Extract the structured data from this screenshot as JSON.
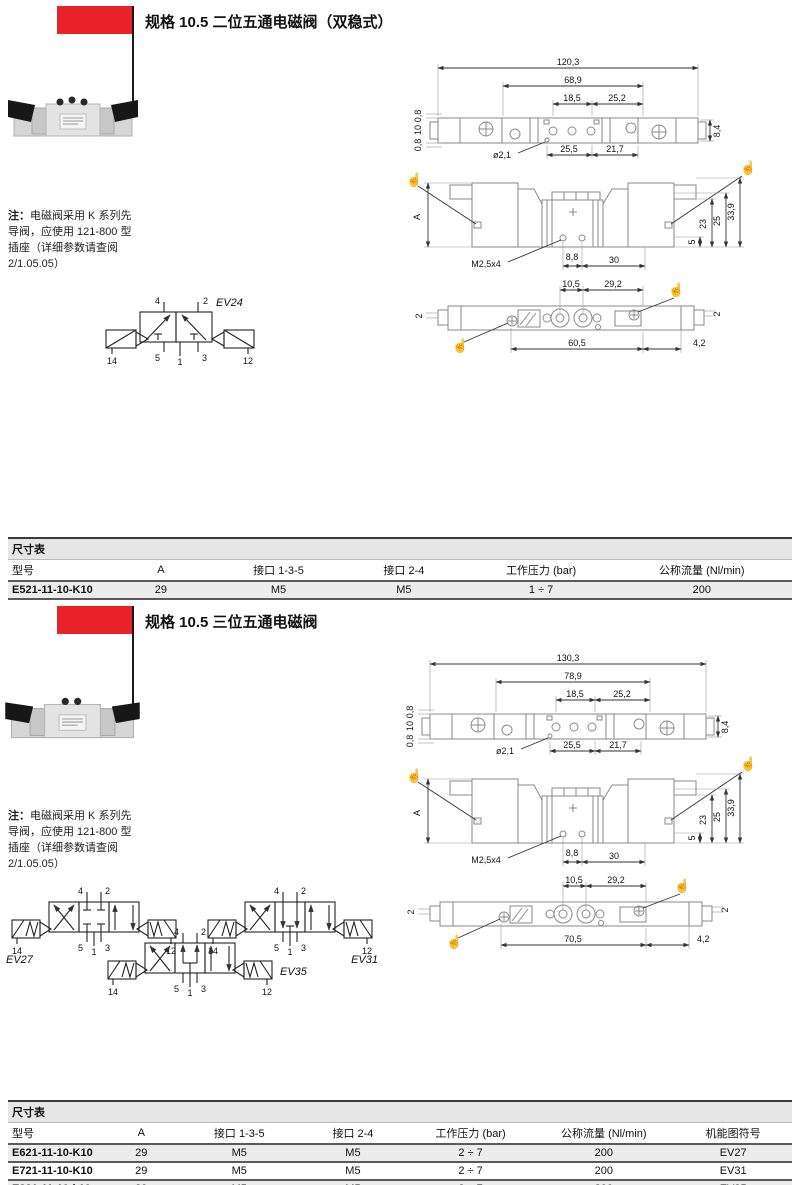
{
  "colors": {
    "accent": "#e8212b",
    "table_caption_bg": "#e6e6e6",
    "row_alt_bg": "#ececec"
  },
  "note": {
    "prefix": "注：",
    "l1": "电磁阀采用 K 系列先",
    "l2": "导阀，应使用 121-800 型",
    "l3": "插座（详细参数请查阅",
    "l4": "2/1.05.05）"
  },
  "ports": {
    "p14": "14",
    "p4": "4",
    "p2": "2",
    "p5": "5",
    "p1": "1",
    "p3": "3",
    "p12": "12"
  },
  "s1": {
    "title": "规格 10.5 二位五通电磁阀（双稳式）",
    "symbol": "EV24",
    "top": {
      "d1": "120,3",
      "d2": "68,9",
      "d3": "18,5",
      "d4": "25,2",
      "l1": "0,8",
      "l2": "10",
      "l3": "0,8",
      "r1": "8,4",
      "b1": "ø2,1",
      "b2": "25,5",
      "b3": "21,7"
    },
    "front": {
      "a": "A",
      "thread": "M2,5x4",
      "b1": "8,8",
      "b2": "30",
      "r1": "5",
      "r2": "23",
      "r3": "25",
      "r4": "33,9"
    },
    "bottom": {
      "t1": "10,5",
      "t2": "29,2",
      "s1": "2",
      "s2": "2",
      "b1": "60,5",
      "b2": "4,2"
    },
    "table": {
      "caption": "尺寸表",
      "h": [
        "型号",
        "A",
        "接口 1-3-5",
        "接口 2-4",
        "工作压力 (bar)",
        "公称流量 (Nl/min)"
      ],
      "rows": [
        [
          "E521-11-10-K10",
          "29",
          "M5",
          "M5",
          "1 ÷ 7",
          "200"
        ]
      ]
    }
  },
  "s2": {
    "title": "规格 10.5 三位五通电磁阀",
    "symbol27": "EV27",
    "symbol31": "EV31",
    "symbol35": "EV35",
    "top": {
      "d1": "130,3",
      "d2": "78,9",
      "d3": "18,5",
      "d4": "25,2",
      "l1": "0,8",
      "l2": "10",
      "l3": "0,8",
      "r1": "8,4",
      "b1": "ø2,1",
      "b2": "25,5",
      "b3": "21,7"
    },
    "front": {
      "a": "A",
      "thread": "M2,5x4",
      "b1": "8,8",
      "b2": "30",
      "r1": "5",
      "r2": "23",
      "r3": "25",
      "r4": "33,9"
    },
    "bottom": {
      "t1": "10,5",
      "t2": "29,2",
      "s1": "2",
      "s2": "2",
      "b1": "70,5",
      "b2": "4,2"
    },
    "table": {
      "caption": "尺寸表",
      "h": [
        "型号",
        "A",
        "接口 1-3-5",
        "接口 2-4",
        "工作压力 (bar)",
        "公称流量 (Nl/min)",
        "机能图符号"
      ],
      "rows": [
        [
          "E621-11-10-K10",
          "29",
          "M5",
          "M5",
          "2 ÷ 7",
          "200",
          "EV27"
        ],
        [
          "E721-11-10-K10",
          "29",
          "M5",
          "M5",
          "2 ÷ 7",
          "200",
          "EV31"
        ],
        [
          "E821-11-10-k10",
          "29",
          "M5",
          "M5",
          "2 ÷ 7",
          "200",
          "EV35"
        ]
      ]
    }
  }
}
